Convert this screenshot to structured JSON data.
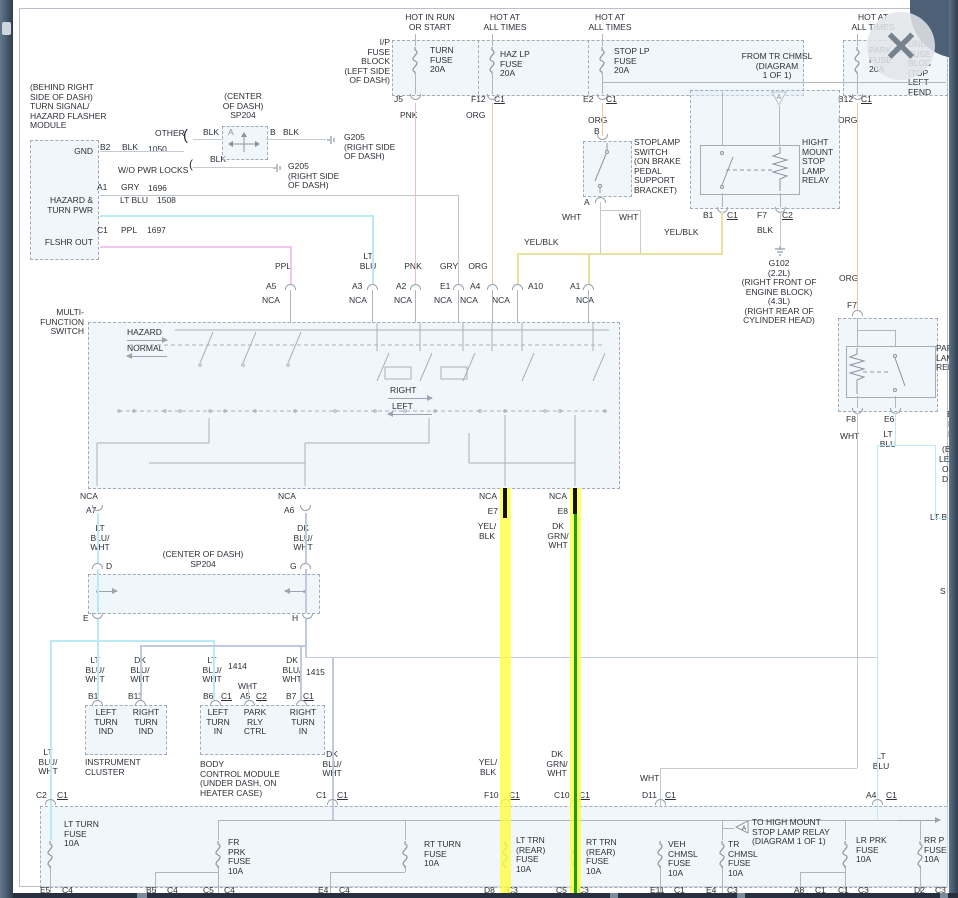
{
  "colors": {
    "highlight_yellow": "#ffff3c",
    "wire_green": "#18a018",
    "wire_cyan": "#baeaf8",
    "wire_pink": "#f0bcc6",
    "wire_orange": "#f3c59e",
    "wire_purple": "#f2c7ee",
    "wire_pale_yellow": "#e8dfa0"
  },
  "window": {
    "close_icon": "✕"
  },
  "headers": {
    "h1": "HOT IN RUN\nOR START",
    "h2": "HOT AT\nALL TIMES",
    "h3": "HOT AT\nALL TIMES",
    "h4": "HOT AT\nALL TIMES"
  },
  "ip_block": {
    "label": "I/P\nFUSE\nBLOCK\n(LEFT SIDE\nOF DASH)",
    "turn_fuse": "TURN\nFUSE\n20A",
    "haz_fuse": "HAZ LP\nFUSE\n20A",
    "stop_fuse": "STOP LP\nFUSE\n20A",
    "j5": "J5",
    "f12": "F12",
    "c1a": "C1",
    "e2": "E2",
    "c1b": "C1",
    "pnk": "PNK",
    "org_a": "ORG",
    "org_b": "ORG"
  },
  "underhood": {
    "label": "UNDE\nFUSE\nBLOC\n(TOP\nLEFT\nFEND",
    "park_fuse": "PARK LP\nFUSE\n20A",
    "b12": "B12",
    "c1": "C1",
    "org": "ORG"
  },
  "stoplamp": {
    "label": "STOPLAMP\nSWITCH\n(ON BRAKE\nPEDAL\nSUPPORT\nBRACKET)",
    "b": "B",
    "a": "A",
    "wht1": "WHT",
    "wht2": "WHT",
    "yelblk_l": "YEL/BLK",
    "yelblk_r": "YEL/BLK"
  },
  "hm_relay": {
    "from": "FROM TR CHMSL\n(DIAGRAM\n1 OF 1)",
    "tri": "A",
    "label": "HIGHT\nMOUNT\nSTOP\nLAMP\nRELAY",
    "b1": "B1",
    "c1": "C1",
    "f7": "F7",
    "c2": "C2",
    "blk": "BLK",
    "g102": "G102\n(2.2L)\n(RIGHT FRONT OF\nENGINE BLOCK)\n(4.3L)\n(RIGHT REAR OF\nCYLINDER HEAD)"
  },
  "park_relay": {
    "org": "ORG",
    "f7": "F7",
    "label": "PAR\nLAM\nREL",
    "f8": "F8",
    "e6": "E6",
    "wht": "WHT",
    "ltblu": "LT\nBLU"
  },
  "edge": {
    "f1": "B",
    "f2": "R",
    "f3": "B",
    "f4": "(BE",
    "f5": "LEFT",
    "f6": "OF D",
    "f7": "LT B",
    "f8": "S"
  },
  "module": {
    "label": "(BEHIND RIGHT\nSIDE OF DASH)\nTURN SIGNAL/\nHAZARD FLASHER\nMODULE",
    "gnd": "GND",
    "b2": "B2",
    "blk1": "BLK",
    "w1050": "1050",
    "other": "OTHER",
    "brace1": "(",
    "brace2": "(",
    "wo_pwr": "W/O PWR LOCKS",
    "a1": "A1",
    "gry": "GRY",
    "w1696": "1696",
    "ltblu": "LT BLU",
    "w1508": "1508",
    "hazard": "HAZARD &\nTURN PWR",
    "c1": "C1",
    "ppl": "PPL",
    "w1697": "1697",
    "flshr": "FLSHR OUT"
  },
  "sp204a": {
    "label": "(CENTER\nOF DASH)\nSP204",
    "blk_a": "BLK",
    "a": "A",
    "b": "B",
    "blk_b": "BLK",
    "blk_c": "BLK",
    "g205a": "G205\n(RIGHT SIDE\nOF DASH)",
    "g205b": "G205\n(RIGHT SIDE\nOF DASH)"
  },
  "mfs": {
    "label": "MULTI-\nFUNCTION\nSWITCH",
    "hazard": "HAZARD",
    "normal": "NORMAL",
    "right": "RIGHT",
    "left": "LEFT",
    "nca": "NCA",
    "inputs": [
      {
        "wire": "PPL",
        "pin": "A5"
      },
      {
        "wire": "LT\nBLU",
        "pin": "A3"
      },
      {
        "wire": "PNK",
        "pin": "A2"
      },
      {
        "wire": "GRY",
        "pin": "E1"
      },
      {
        "wire": "ORG",
        "pin": "A4"
      },
      {
        "wire": "",
        "pin": "A10"
      },
      {
        "wire": "",
        "pin": "A1"
      }
    ],
    "outputs": [
      {
        "pin": "A7",
        "wire": "LT\nBLU/\nWHT"
      },
      {
        "pin": "A6",
        "wire": "DK\nBLU/\nWHT"
      },
      {
        "pin": "E7",
        "wire": "YEL/\nBLK"
      },
      {
        "pin": "E8",
        "wire": "DK\nGRN/\nWHT"
      }
    ]
  },
  "sp204b": {
    "label": "(CENTER OF DASH)\nSP204",
    "d": "D",
    "g": "G",
    "e": "E",
    "h": "H"
  },
  "cluster": {
    "wl": "LT\nBLU/\nWHT",
    "b1": "B1",
    "wr": "DK\nBLU/\nWHT",
    "b11": "B11",
    "li": "LEFT\nTURN\nIND",
    "ri": "RIGHT\nTURN\nIND",
    "title": "INSTRUMENT\nCLUSTER"
  },
  "bcm": {
    "wl": "LT\nBLU/\nWHT",
    "n1414": "1414",
    "b6": "B6",
    "c1a": "C1",
    "wht": "WHT",
    "a5": "A5",
    "c2": "C2",
    "wr": "DK\nBLU/\nWHT",
    "n1415": "1415",
    "b7": "B7",
    "c1b": "C1",
    "li": "LEFT\nTURN\nIN",
    "pc": "PARK\nRLY\nCTRL",
    "ri": "RIGHT\nTURN\nIN",
    "title": "BODY\nCONTROL MODULE\n(UNDER DASH, ON\nHEATER CASE)"
  },
  "mid": {
    "ltbw": "LT\nBLU/\nWHT",
    "dkbw": "DK\nBLU/\nWHT",
    "yelblk": "YEL/\nBLK",
    "dkgrn": "DK\nGRN/\nWHT",
    "wht": "WHT",
    "ltblu": "LT\nBLU"
  },
  "block": {
    "note": "TO HIGH MOUNT\nSTOP LAMP RELAY\n(DIAGRAM 1 OF 1)",
    "tri": "A",
    "fuses": [
      {
        "name": "LT TURN\nFUSE\n10A",
        "t1": "C2",
        "t2": "C1",
        "b1": "E5",
        "b2": "C4"
      },
      {
        "name": "FR\nPRK\nFUSE\n10A",
        "b1": "C5",
        "b2": "C4",
        "x1": "B5",
        "x2": "C4"
      },
      {
        "name": "RT TURN\nFUSE\n10A",
        "t1": "C1",
        "t2": "C1",
        "b1": "E4",
        "b2": "C4"
      },
      {
        "name": "LT TRN\n(REAR)\nFUSE\n10A",
        "t1": "F10",
        "t2": "C1",
        "b1": "D8",
        "b2": "C3"
      },
      {
        "name": "RT TRN\n(REAR)\nFUSE\n10A",
        "t1": "C10",
        "t2": "C1",
        "b1": "C5",
        "b2": "C3"
      },
      {
        "name": "VEH\nCHMSL\nFUSE\n10A",
        "t1": "D11",
        "t2": "C1",
        "b1": "E11",
        "b2": "C1"
      },
      {
        "name": "TR\nCHMSL\nFUSE\n10A",
        "b1": "E4",
        "b2": "C3"
      },
      {
        "name": "LR PRK\nFUSE\n10A",
        "t1": "A4",
        "t2": "C1",
        "b1": "A8",
        "b2": "C1",
        "x1": "C1",
        "x2": "C3"
      },
      {
        "name": "RR P\nFUSE\n10A",
        "b1": "D2",
        "b2": "C3"
      }
    ]
  }
}
